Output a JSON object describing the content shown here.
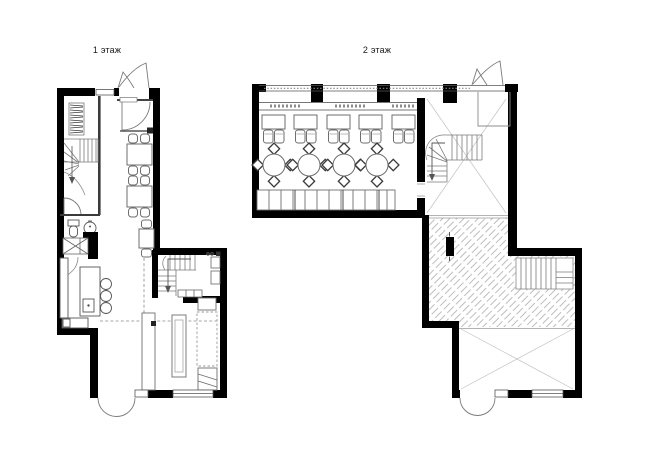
{
  "page": {
    "background": "#ffffff"
  },
  "floors": [
    {
      "id": "floor-1",
      "label": "1 этаж"
    },
    {
      "id": "floor-2",
      "label": "2 этаж"
    }
  ],
  "colors": {
    "walls": "#000000",
    "furniture_line": "#6e6e6e",
    "thin_line": "#9a9a9a",
    "cross_line": "#c2c2c2",
    "hatch": "#a8a8a8",
    "text": "#1a1a1a"
  }
}
